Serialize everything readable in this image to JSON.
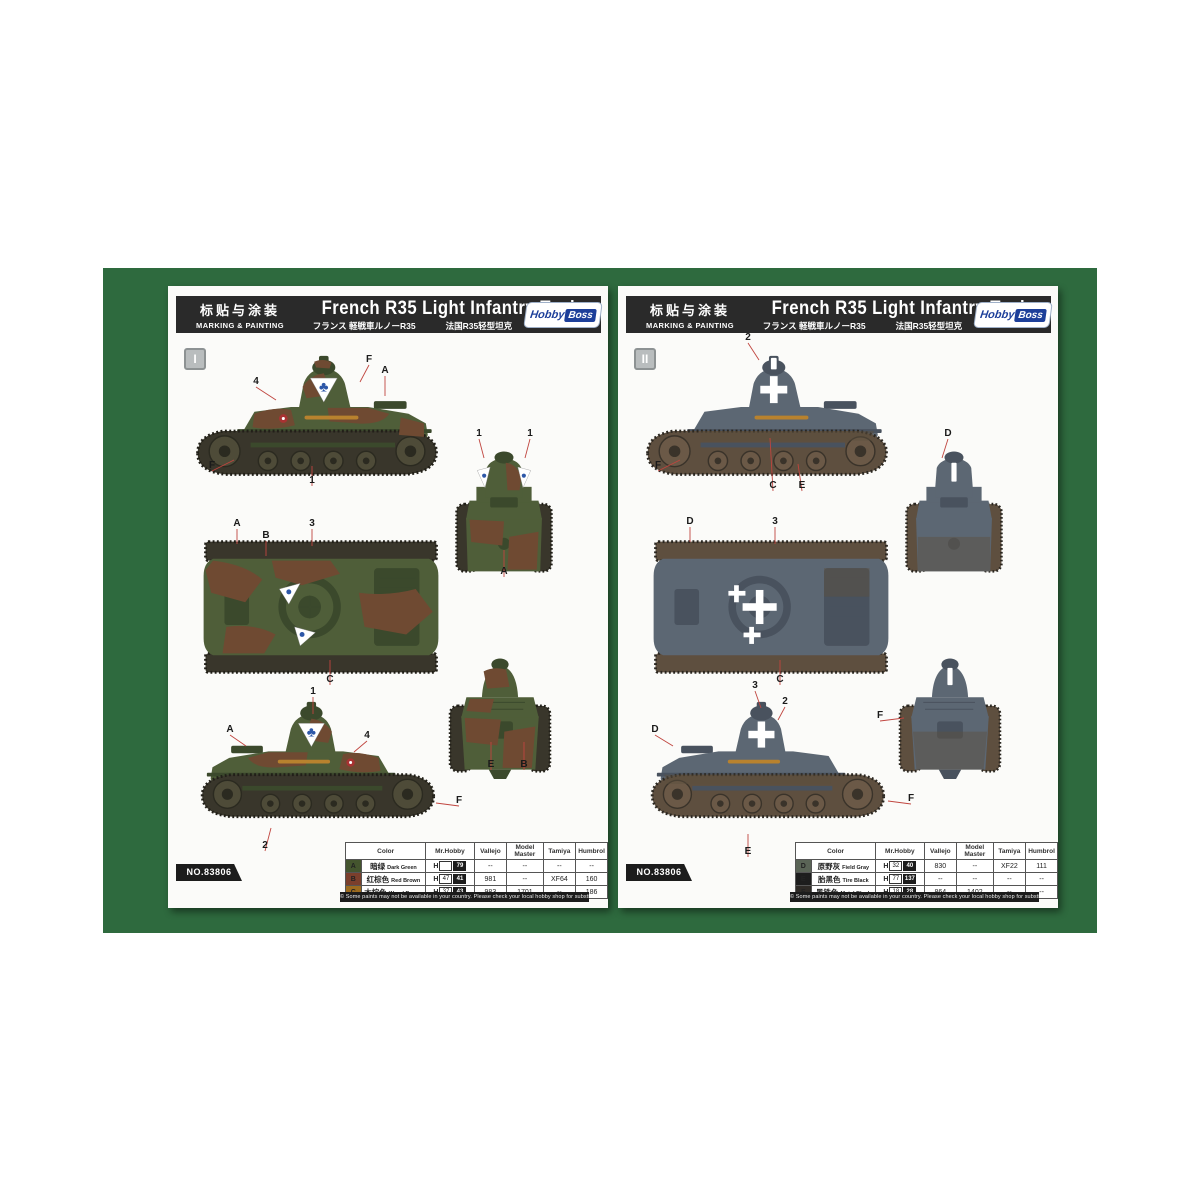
{
  "palette": {
    "mat_green": "#2e6a3e",
    "page_bg": "#fbfbf9",
    "header_bg": "#2a2a2a",
    "logo_blue": "#1d3f9a",
    "logo_red": "#c03030",
    "leader_red": "#c0453f"
  },
  "common": {
    "header": {
      "cn_label": "标贴与涂装",
      "en_label": "MARKING & PAINTING",
      "title": "French R35 Light Infantry Tank",
      "subtitle_jp": "フランス 軽戦車ルノーR35",
      "subtitle_cn": "法国R35轻型坦克",
      "logo_part1": "Hobby",
      "logo_part2": "Boss"
    },
    "kit_no": "NO.83806",
    "footer_note": "© Some paints may not be available in your country. Please check your local hobby shop for substitute",
    "table_headers": [
      "Color",
      "Mr.Hobby",
      "Vallejo",
      "Model Master",
      "Tamiya",
      "Humbrol"
    ]
  },
  "pages": [
    {
      "scheme_label": "I",
      "marking_symbol": "♣",
      "scheme_colors": {
        "base": "#4f5e39",
        "dark": "#3b492c",
        "track": "#39362b",
        "trackline": "#211f18",
        "wheel": "#4e4b38",
        "hub": "#2b2a20",
        "camo": "#6f4a32",
        "mark": "#2d57a8",
        "accent": "#b8822e",
        "roundel": "#a83232"
      },
      "table_rows": [
        {
          "letter": "A",
          "swatch": "#44552e",
          "cn": "暗绿",
          "en": "Dark Green",
          "mrhobby": [
            "",
            "79"
          ],
          "vallejo": "--",
          "model_master": "--",
          "tamiya": "--",
          "humbrol": "--"
        },
        {
          "letter": "B",
          "swatch": "#7b3f2c",
          "cn": "红棕色",
          "en": "Red Brown",
          "mrhobby": [
            "47",
            "41"
          ],
          "vallejo": "981",
          "model_master": "--",
          "tamiya": "XF64",
          "humbrol": "160"
        },
        {
          "letter": "C",
          "swatch": "#9c6b1f",
          "cn": "木棕色",
          "en": "Wood Brown",
          "mrhobby": [
            "37",
            "43"
          ],
          "vallejo": "983",
          "model_master": "1701",
          "tamiya": "--",
          "humbrol": "186"
        }
      ],
      "callouts": [
        {
          "t": "4",
          "x": 88,
          "y": 98,
          "x2": 108,
          "y2": 114
        },
        {
          "t": "F",
          "x": 201,
          "y": 76,
          "x2": 192,
          "y2": 96
        },
        {
          "t": "A",
          "x": 217,
          "y": 87,
          "x2": 217,
          "y2": 110
        },
        {
          "t": "F",
          "x": 44,
          "y": 182,
          "x2": 66,
          "y2": 174
        },
        {
          "t": "1",
          "x": 144,
          "y": 197,
          "x2": 144,
          "y2": 180
        },
        {
          "t": "A",
          "x": 69,
          "y": 240,
          "x2": 69,
          "y2": 258
        },
        {
          "t": "B",
          "x": 98,
          "y": 252,
          "x2": 98,
          "y2": 270
        },
        {
          "t": "3",
          "x": 144,
          "y": 240,
          "x2": 144,
          "y2": 260
        },
        {
          "t": "C",
          "x": 162,
          "y": 396,
          "x2": 162,
          "y2": 374
        },
        {
          "t": "1",
          "x": 311,
          "y": 150,
          "x2": 316,
          "y2": 172
        },
        {
          "t": "1",
          "x": 362,
          "y": 150,
          "x2": 357,
          "y2": 172
        },
        {
          "t": "A",
          "x": 336,
          "y": 288,
          "x2": 336,
          "y2": 264
        },
        {
          "t": "E",
          "x": 323,
          "y": 481,
          "x2": 323,
          "y2": 456
        },
        {
          "t": "B",
          "x": 356,
          "y": 481,
          "x2": 356,
          "y2": 456
        },
        {
          "t": "1",
          "x": 145,
          "y": 408,
          "x2": 145,
          "y2": 428
        },
        {
          "t": "A",
          "x": 62,
          "y": 446,
          "x2": 78,
          "y2": 460
        },
        {
          "t": "4",
          "x": 199,
          "y": 452,
          "x2": 186,
          "y2": 466
        },
        {
          "t": "F",
          "x": 291,
          "y": 517,
          "x2": 268,
          "y2": 517
        },
        {
          "t": "2",
          "x": 97,
          "y": 562,
          "x2": 103,
          "y2": 542
        }
      ]
    },
    {
      "scheme_label": "II",
      "marking_symbol": "✚",
      "scheme_colors": {
        "base": "#5c6773",
        "dark": "#49525e",
        "track": "#5e4f3f",
        "trackline": "#2b2721",
        "wheel": "#6b5947",
        "hub": "#3a332a",
        "camo": "#525c67",
        "mark": "#ffffff",
        "accent": "#b8822e",
        "roundel": "#a83232"
      },
      "table_rows": [
        {
          "letter": "D",
          "swatch": "#5a6456",
          "cn": "原野灰",
          "en": "Field Gray",
          "mrhobby": [
            "32",
            "40"
          ],
          "vallejo": "830",
          "model_master": "--",
          "tamiya": "XF22",
          "humbrol": "111"
        },
        {
          "letter": "E",
          "swatch": "#1d1d1d",
          "cn": "胎黑色",
          "en": "Tire Black",
          "mrhobby": [
            "77",
            "137"
          ],
          "vallejo": "--",
          "model_master": "--",
          "tamiya": "--",
          "humbrol": "--"
        },
        {
          "letter": "F",
          "swatch": "#2e2a26",
          "cn": "黑铁色",
          "en": "Metal Black",
          "mrhobby": [
            "18",
            "28"
          ],
          "vallejo": "864",
          "model_master": "1402",
          "tamiya": "--",
          "humbrol": "--"
        }
      ],
      "callouts": [
        {
          "t": "2",
          "x": 130,
          "y": 54,
          "x2": 141,
          "y2": 74
        },
        {
          "t": "F",
          "x": 40,
          "y": 182,
          "x2": 62,
          "y2": 174
        },
        {
          "t": "C",
          "x": 155,
          "y": 202,
          "x2": 152,
          "y2": 152
        },
        {
          "t": "E",
          "x": 184,
          "y": 202,
          "x2": 180,
          "y2": 178
        },
        {
          "t": "D",
          "x": 330,
          "y": 150,
          "x2": 324,
          "y2": 172
        },
        {
          "t": "D",
          "x": 72,
          "y": 238,
          "x2": 72,
          "y2": 256
        },
        {
          "t": "3",
          "x": 157,
          "y": 238,
          "x2": 157,
          "y2": 258
        },
        {
          "t": "C",
          "x": 162,
          "y": 396,
          "x2": 162,
          "y2": 374
        },
        {
          "t": "F",
          "x": 262,
          "y": 432,
          "x2": 286,
          "y2": 432
        },
        {
          "t": "3",
          "x": 137,
          "y": 402,
          "x2": 143,
          "y2": 422
        },
        {
          "t": "2",
          "x": 167,
          "y": 418,
          "x2": 160,
          "y2": 434
        },
        {
          "t": "D",
          "x": 37,
          "y": 446,
          "x2": 55,
          "y2": 460
        },
        {
          "t": "F",
          "x": 293,
          "y": 515,
          "x2": 270,
          "y2": 515
        },
        {
          "t": "E",
          "x": 130,
          "y": 568,
          "x2": 130,
          "y2": 548
        }
      ]
    }
  ]
}
